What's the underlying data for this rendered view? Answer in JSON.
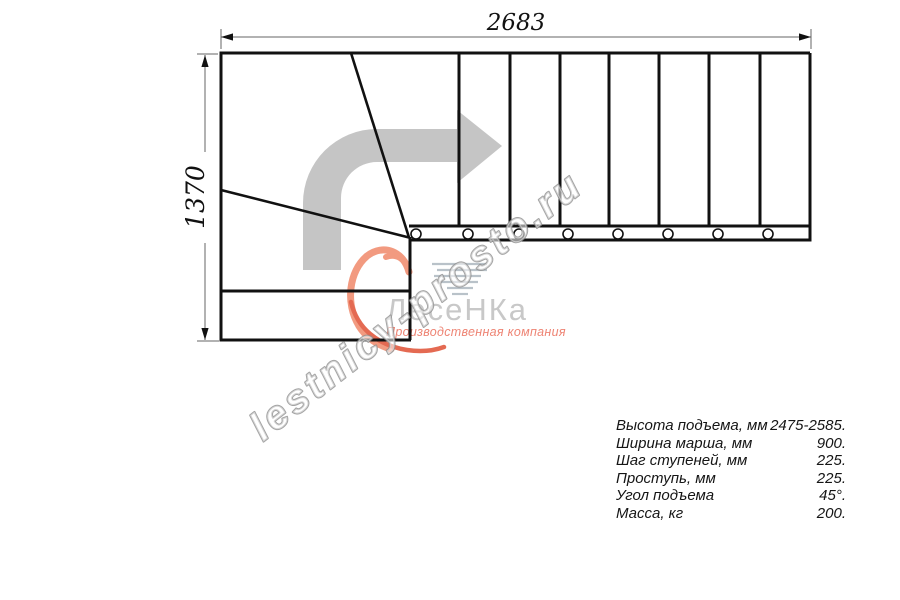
{
  "drawing": {
    "type": "staircase-plan-top-view",
    "top_dimension_mm": "2683",
    "left_dimension_mm": "1370",
    "direction_arrow": "up-then-right"
  },
  "watermark": {
    "text": "lestnicy-prosto.ru"
  },
  "logo": {
    "brand": "ЛесеНКа",
    "tagline": "Производственная компания"
  },
  "specs": {
    "rows": [
      {
        "label": "Высота подъема, мм",
        "value": "2475-2585."
      },
      {
        "label": "Ширина марша, мм",
        "value": "900."
      },
      {
        "label": "Шаг ступеней, мм",
        "value": "225."
      },
      {
        "label": "Проступь, мм",
        "value": "225."
      },
      {
        "label": "Угол подъема",
        "value": "45°."
      },
      {
        "label": "Масса, кг",
        "value": "200."
      }
    ]
  },
  "colors": {
    "arrow": "#c5c5c5",
    "line": "#111111",
    "dim_line": "#666666",
    "logo_accent": "#f29a80",
    "logo_tail": "#e46a52",
    "logo_text": "#c8c8c8",
    "tagline": "#ee8474",
    "hatch": "#b9c2c9",
    "watermark_stroke": "#8d8d8d"
  }
}
